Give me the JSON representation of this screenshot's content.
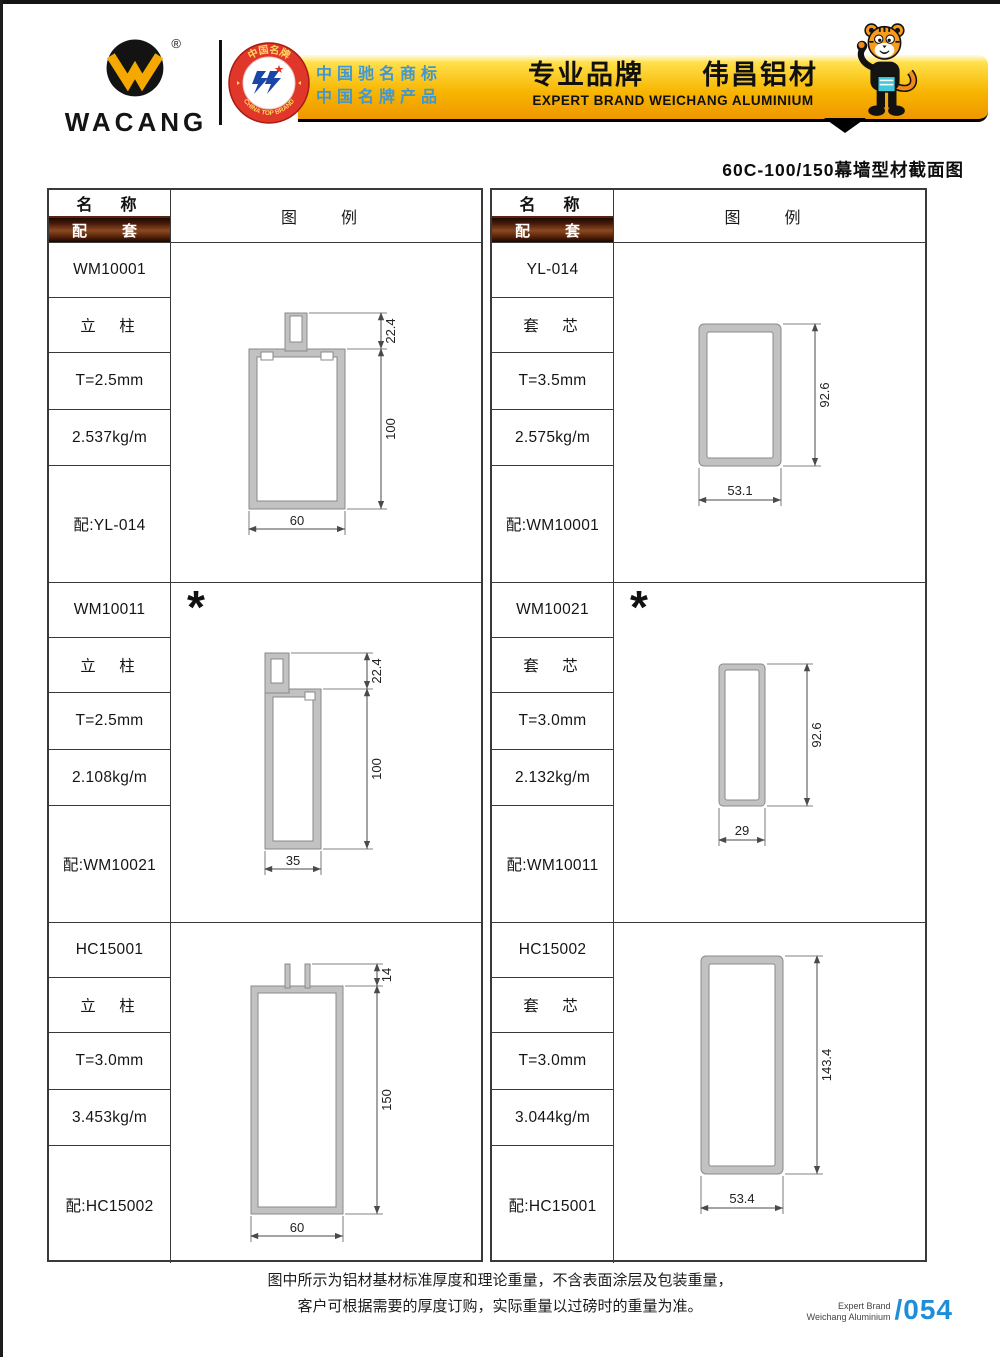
{
  "brand": {
    "logo_text": "WACANG",
    "registered": "®",
    "badge_top": "中国名牌",
    "badge_bottom": "CHINA TOP BRAND",
    "banner_line1": "中国驰名商标",
    "banner_line2": "中国名牌产品",
    "banner_title": "专业品牌　　伟昌铝材",
    "banner_subtitle": "EXPERT BRAND WEICHANG ALUMINIUM"
  },
  "page_title": "60C-100/150幕墙型材截面图",
  "columns": {
    "name": "名　称",
    "fit": "配　套",
    "legend": "图　例"
  },
  "marker": "*",
  "left_blocks": [
    {
      "model": "WM10001",
      "type": "立　柱",
      "thickness": "T=2.5mm",
      "weight": "2.537kg/m",
      "fit": "配:YL-014",
      "dims": {
        "v1": "22.4",
        "v2": "100",
        "w": "60"
      }
    },
    {
      "model": "WM10011",
      "type": "立　柱",
      "thickness": "T=2.5mm",
      "weight": "2.108kg/m",
      "fit": "配:WM10021",
      "dims": {
        "v1": "22.4",
        "v2": "100",
        "w": "35"
      }
    },
    {
      "model": "HC15001",
      "type": "立　柱",
      "thickness": "T=3.0mm",
      "weight": "3.453kg/m",
      "fit": "配:HC15002",
      "dims": {
        "v1": "14",
        "v2": "150",
        "w": "60"
      }
    }
  ],
  "right_blocks": [
    {
      "model": "YL-014",
      "type": "套　芯",
      "thickness": "T=3.5mm",
      "weight": "2.575kg/m",
      "fit": "配:WM10001",
      "dims": {
        "v": "92.6",
        "w": "53.1"
      }
    },
    {
      "model": "WM10021",
      "type": "套　芯",
      "thickness": "T=3.0mm",
      "weight": "2.132kg/m",
      "fit": "配:WM10011",
      "dims": {
        "v": "92.6",
        "w": "29"
      }
    },
    {
      "model": "HC15002",
      "type": "套　芯",
      "thickness": "T=3.0mm",
      "weight": "3.044kg/m",
      "fit": "配:HC15001",
      "dims": {
        "v": "143.4",
        "w": "53.4"
      }
    }
  ],
  "footer": {
    "note_line1": "图中所示为铝材基材标准厚度和理论重量，不含表面涂层及包装重量，",
    "note_line2": "客户可根据需要的厚度订购，实际重量以过磅时的重量为准。",
    "brand_line1": "Expert Brand",
    "brand_line2": "Weichang Aluminium",
    "page_number": "/054"
  }
}
